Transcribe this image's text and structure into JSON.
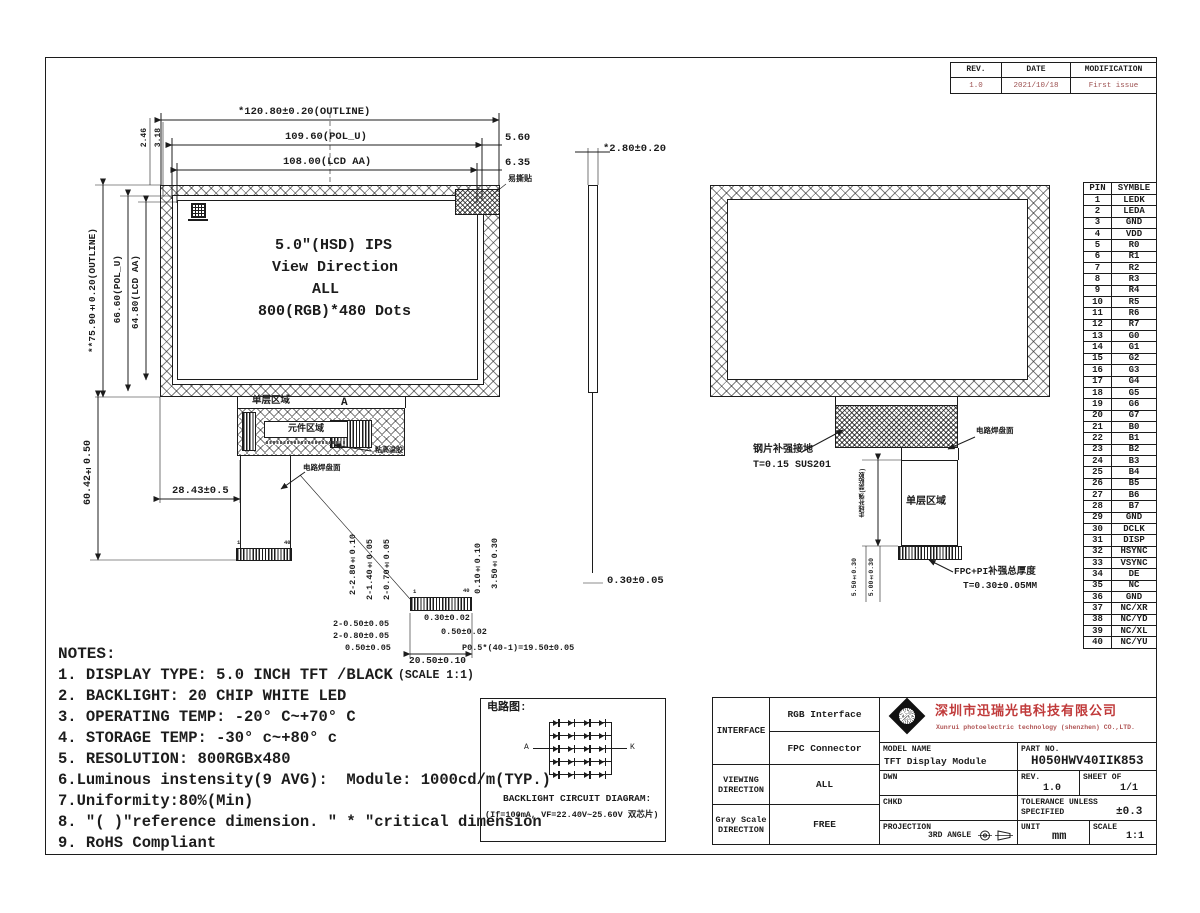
{
  "rev_table": {
    "headers": [
      "REV.",
      "DATE",
      "MODIFICATION"
    ],
    "rev": "1.0",
    "date": "2021/10/18",
    "modification": "First issue"
  },
  "front_view": {
    "dim_outline_w": "*120.80±0.20(OUTLINE)",
    "dim_pol_w": "109.60(POL_U)",
    "dim_lcd_w": "108.00(LCD AA)",
    "dim_right_top": "5.60",
    "dim_right_bottom": "6.35",
    "dim_outline_h": "**75.90±0.20(OUTLINE)",
    "dim_pol_h": "66.60(POL_U)",
    "dim_lcd_h": "64.80(LCD AA)",
    "dim_border_top_1": "2.46",
    "dim_border_top_2": "3.18",
    "dim_fpc_h": "60.42±0.50",
    "dim_fpc_offset": "28.43±0.5",
    "center_line_1": "5.0″(HSD) IPS",
    "center_line_2": "View Direction",
    "center_line_3": "ALL",
    "center_line_4": "800(RGB)*480 Dots",
    "easy_tear_label": "易撕贴",
    "single_layer_label": "单层区域",
    "section_mark": "A",
    "component_area_label": "元件区域",
    "adhesive_label": "粘高温胶",
    "pad_side_label": "电路焊盘面",
    "pin1": "1",
    "pin40": "40"
  },
  "connector_detail": {
    "dim_rot_1": "2-2.80±0.10",
    "dim_rot_2": "2-1.40±0.05",
    "dim_rot_3": "2-0.70±0.05",
    "dim_rot_4": "0.10±0.10",
    "dim_rot_5": "3.50±0.30",
    "dim_h_1": "2-0.50±0.05",
    "dim_h_2": "2-0.80±0.05",
    "dim_h_3": "0.50±0.05",
    "dim_h_4": "0.30±0.02",
    "dim_h_5": "0.50±0.02",
    "dim_pitch": "P0.5*(40-1)=19.50±0.05",
    "dim_width": "20.50±0.10",
    "scale_note": "(SCALE 1:1)",
    "pin1": "1",
    "pin40": "40"
  },
  "side_view": {
    "dim_thickness": "*2.80±0.20",
    "dim_fpc": "0.30±0.05"
  },
  "back_view": {
    "steel_label_1": "钢片补强接地",
    "steel_label_2": "T=0.15 SUS201",
    "pad_side_label": "电路焊盘面",
    "single_layer_label": "单层区域",
    "fpc_pi_label_1": "FPC+PI补强总厚度",
    "fpc_pi_label_2": "T=0.30±0.05MM",
    "dim_v_1": "5.50±0.30",
    "dim_v_2": "5.00±0.30",
    "trace_label": "走线补强(禁贴胶)"
  },
  "pin_table": {
    "headers": [
      "PIN",
      "SYMBLE"
    ],
    "rows": [
      [
        "1",
        "LEDK"
      ],
      [
        "2",
        "LEDA"
      ],
      [
        "3",
        "GND"
      ],
      [
        "4",
        "VDD"
      ],
      [
        "5",
        "R0"
      ],
      [
        "6",
        "R1"
      ],
      [
        "7",
        "R2"
      ],
      [
        "8",
        "R3"
      ],
      [
        "9",
        "R4"
      ],
      [
        "10",
        "R5"
      ],
      [
        "11",
        "R6"
      ],
      [
        "12",
        "R7"
      ],
      [
        "13",
        "G0"
      ],
      [
        "14",
        "G1"
      ],
      [
        "15",
        "G2"
      ],
      [
        "16",
        "G3"
      ],
      [
        "17",
        "G4"
      ],
      [
        "18",
        "G5"
      ],
      [
        "19",
        "G6"
      ],
      [
        "20",
        "G7"
      ],
      [
        "21",
        "B0"
      ],
      [
        "22",
        "B1"
      ],
      [
        "23",
        "B2"
      ],
      [
        "24",
        "B3"
      ],
      [
        "25",
        "B4"
      ],
      [
        "26",
        "B5"
      ],
      [
        "27",
        "B6"
      ],
      [
        "28",
        "B7"
      ],
      [
        "29",
        "GND"
      ],
      [
        "30",
        "DCLK"
      ],
      [
        "31",
        "DISP"
      ],
      [
        "32",
        "HSYNC"
      ],
      [
        "33",
        "VSYNC"
      ],
      [
        "34",
        "DE"
      ],
      [
        "35",
        "NC"
      ],
      [
        "36",
        "GND"
      ],
      [
        "37",
        "NC/XR"
      ],
      [
        "38",
        "NC/YD"
      ],
      [
        "39",
        "NC/XL"
      ],
      [
        "40",
        "NC/YU"
      ]
    ]
  },
  "notes": {
    "title": "NOTES:",
    "lines": [
      "1. DISPLAY TYPE: 5.0 INCH TFT /BLACK",
      "2. BACKLIGHT: 20 CHIP WHITE LED",
      "3. OPERATING TEMP: -20° C~+70° C",
      "4. STORAGE TEMP: -30° c~+80° c",
      "5. RESOLUTION: 800RGBx480",
      "6.Luminous instensity(9 AVG):  Module: 1000cd/m(TYP.)",
      "7.Uniformity:80%(Min)",
      "8. ″( )″reference dimension. ″ * ″critical dimension",
      "9. RoHS Compliant"
    ]
  },
  "backlight": {
    "title": "电路图:",
    "anode": "A",
    "cathode": "K",
    "caption_1": "BACKLIGHT CIRCUIT DIAGRAM:",
    "caption_2": "(If=100mA, VF=22.40V~25.60V 双芯片)"
  },
  "title_block": {
    "interface_label": "INTERFACE",
    "interface_1": "RGB Interface",
    "interface_2": "FPC Connector",
    "viewing_label_1": "VIEWING",
    "viewing_label_2": "DIRECTION",
    "viewing_value": "ALL",
    "gray_label_1": "Gray Scale",
    "gray_label_2": "DIRECTION",
    "gray_value": "FREE",
    "company_cn": "深圳市迅瑞光电科技有限公司",
    "company_en": "Xunrui photoelectric technology (shenzhen) CO.,LTD.",
    "model_label": "MODEL NAME",
    "model_value": "TFT Display Module",
    "part_label": "PART NO.",
    "part_value": "H050HWV40IIK853",
    "dwn_label": "DWN",
    "chkd_label": "CHKD",
    "rev_label": "REV.",
    "rev_value": "1.0",
    "sheet_label": "SHEET OF",
    "sheet_value": "1/1",
    "tol_label_1": "TOLERANCE UNLESS",
    "tol_label_2": "SPECIFIED",
    "tol_value": "±0.3",
    "projection_label": "PROJECTION",
    "projection_value": "3RD ANGLE",
    "unit_label": "UNIT",
    "unit_value": "mm",
    "scale_label": "SCALE",
    "scale_value": "1:1"
  },
  "colors": {
    "line": "#1c1c1c",
    "company_red": "#c03a3a",
    "rev_value_red": "#9c5050"
  }
}
